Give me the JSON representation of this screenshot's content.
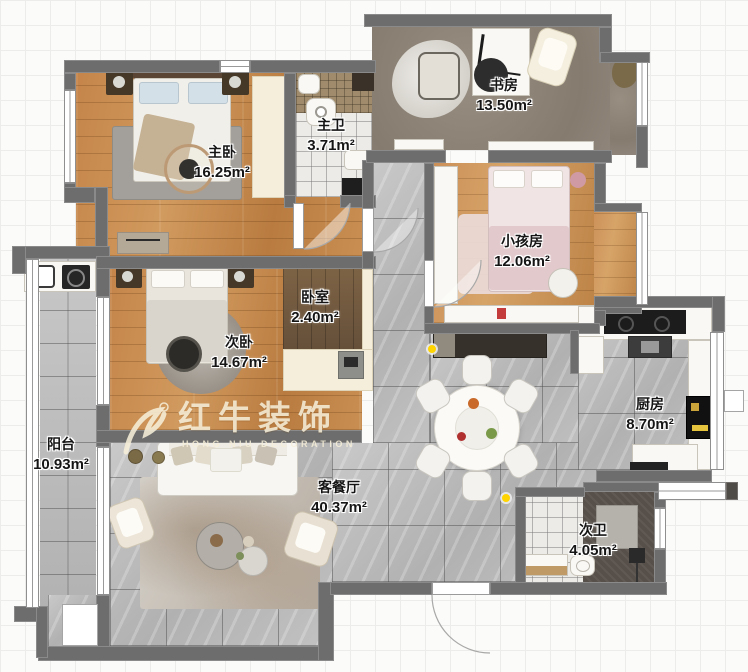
{
  "watermark": {
    "brand": "红牛装饰",
    "subtitle": "HONG NIU DECORATION"
  },
  "rooms": {
    "master_bedroom": {
      "name": "主卧",
      "area": "16.25m²"
    },
    "master_bath": {
      "name": "主卫",
      "area": "3.71m²"
    },
    "study": {
      "name": "书房",
      "area": "13.50m²"
    },
    "kids_room": {
      "name": "小孩房",
      "area": "12.06m²"
    },
    "second_bedroom": {
      "name": "次卧",
      "area": "14.67m²"
    },
    "inner_bedroom": {
      "name": "卧室",
      "area": "2.40m²"
    },
    "balcony": {
      "name": "阳台",
      "area": "10.93m²"
    },
    "living_dining": {
      "name": "客餐厅",
      "area": "40.37m²"
    },
    "kitchen": {
      "name": "厨房",
      "area": "8.70m²"
    },
    "second_bath": {
      "name": "次卫",
      "area": "4.05m²"
    }
  },
  "colors": {
    "wall": "#6d6d6d",
    "wood": "#c5854a",
    "tile": "#bfbfbf",
    "marker": "#ffd400"
  }
}
